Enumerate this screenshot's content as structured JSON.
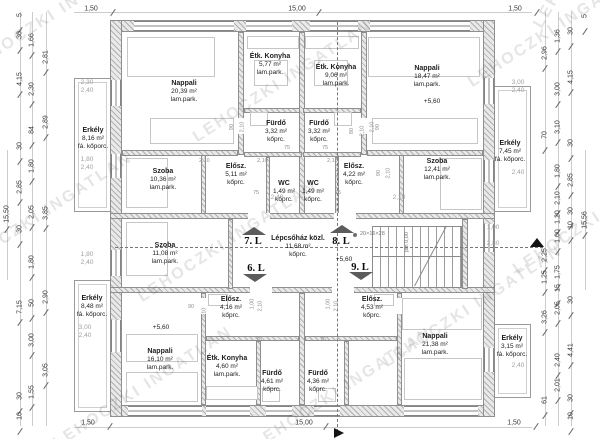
{
  "drawing": {
    "watermark_text": "LEHOCZKI INGATLAN",
    "rooms": [
      {
        "n": "Nappali",
        "a": "20,39 m²",
        "f": "lam.park.",
        "x": 184,
        "y": 80
      },
      {
        "n": "Étk. Konyha",
        "a": "5,77 m²",
        "f": "lam.park.",
        "x": 270,
        "y": 53
      },
      {
        "n": "Fürdő",
        "a": "3,32 m²",
        "f": "kőprc.",
        "x": 276,
        "y": 120
      },
      {
        "n": "Szoba",
        "a": "10,36 m²",
        "f": "lam.park.",
        "x": 163,
        "y": 168
      },
      {
        "n": "Elősz.",
        "a": "5,11 m²",
        "f": "kőprc.",
        "x": 236,
        "y": 163
      },
      {
        "n": "WC",
        "a": "1,49 m²",
        "f": "kőprc.",
        "x": 284,
        "y": 180
      },
      {
        "n": "WC",
        "a": "1,49 m²",
        "f": "kőprc.",
        "x": 313,
        "y": 180
      },
      {
        "n": "Étk. Konyha",
        "a": "9,06 m²",
        "f": "lam.park.",
        "x": 336,
        "y": 64
      },
      {
        "n": "Nappali",
        "a": "18,47 m²",
        "f": "lam.park.",
        "x": 427,
        "y": 65
      },
      {
        "n": "Fürdő",
        "a": "3,32 m²",
        "f": "kőprc.",
        "x": 319,
        "y": 120
      },
      {
        "n": "Elősz.",
        "a": "4,22 m²",
        "f": "kőprc.",
        "x": 354,
        "y": 163
      },
      {
        "n": "Szoba",
        "a": "12,41 m²",
        "f": "lam.park.",
        "x": 437,
        "y": 158
      },
      {
        "n": "Erkély",
        "a": "8,16 m²",
        "f": "fá. kőporc.",
        "x": 93,
        "y": 127
      },
      {
        "n": "Erkély",
        "a": "7,45 m²",
        "f": "fá. kőporc.",
        "x": 510,
        "y": 140
      },
      {
        "n": "Szoba",
        "a": "11,08 m²",
        "f": "lam.park.",
        "x": 165,
        "y": 242
      },
      {
        "n": "Lépcsőház közl.",
        "a": "11,68 m²",
        "f": "kőprc.",
        "x": 298,
        "y": 235
      },
      {
        "n": "Erkély",
        "a": "8,48 m²",
        "f": "fá. kőporc.",
        "x": 92,
        "y": 295
      },
      {
        "n": "Elősz.",
        "a": "4,16 m²",
        "f": "kőprc.",
        "x": 231,
        "y": 296
      },
      {
        "n": "Elősz.",
        "a": "4,53 m²",
        "f": "kőprc.",
        "x": 372,
        "y": 296
      },
      {
        "n": "Étk. Konyha",
        "a": "4,60 m²",
        "f": "lam.park.",
        "x": 227,
        "y": 355
      },
      {
        "n": "Fürdő",
        "a": "4,61 m²",
        "f": "kőprc.",
        "x": 272,
        "y": 370
      },
      {
        "n": "Fürdő",
        "a": "4,36 m²",
        "f": "kőprc.",
        "x": 318,
        "y": 370
      },
      {
        "n": "Nappali",
        "a": "16,10 m²",
        "f": "lam.park.",
        "x": 160,
        "y": 348
      },
      {
        "n": "Nappali",
        "a": "21,38 m²",
        "f": "lam.park.",
        "x": 435,
        "y": 333
      },
      {
        "n": "Erkély",
        "a": "3,15 m²",
        "f": "fá. kőporc.",
        "x": 512,
        "y": 335
      }
    ],
    "units": [
      {
        "t": "7. L",
        "x": 253,
        "y": 236,
        "d": "up",
        "ax": 254,
        "ay": 227
      },
      {
        "t": "8. L",
        "x": 341,
        "y": 236,
        "d": "up",
        "ax": 342,
        "ay": 225
      },
      {
        "t": "6. L",
        "x": 256,
        "y": 263,
        "d": "down",
        "ax": 255,
        "ay": 274
      },
      {
        "t": "9. L",
        "x": 360,
        "y": 262,
        "d": "down",
        "ax": 361,
        "ay": 272
      }
    ],
    "levels": [
      {
        "t": "+5,60",
        "x": 432,
        "y": 98
      },
      {
        "t": "+5,60",
        "x": 344,
        "y": 256
      },
      {
        "t": "+5,60",
        "x": 161,
        "y": 324
      }
    ],
    "dims_h": [
      {
        "t": "1,50",
        "x": 91,
        "y": 5
      },
      {
        "t": "15,00",
        "x": 297,
        "y": 5
      },
      {
        "t": "1,50",
        "x": 515,
        "y": 5
      },
      {
        "t": "1,50",
        "x": 88,
        "y": 419
      },
      {
        "t": "15,00",
        "x": 304,
        "y": 419
      },
      {
        "t": "1,50",
        "x": 514,
        "y": 419
      }
    ],
    "dims_v": [
      {
        "t": "5",
        "x": 20,
        "y": 15
      },
      {
        "t": "30",
        "x": 20,
        "y": 35
      },
      {
        "t": "4,15",
        "x": 20,
        "y": 79
      },
      {
        "t": "30",
        "x": 20,
        "y": 146
      },
      {
        "t": "2,85",
        "x": 20,
        "y": 187
      },
      {
        "t": "30",
        "x": 20,
        "y": 229
      },
      {
        "t": "7,15",
        "x": 20,
        "y": 307
      },
      {
        "t": "30",
        "x": 20,
        "y": 396
      },
      {
        "t": "10",
        "x": 20,
        "y": 416
      },
      {
        "t": "1,66",
        "x": 32,
        "y": 40
      },
      {
        "t": "2,30",
        "x": 32,
        "y": 89
      },
      {
        "t": "84",
        "x": 32,
        "y": 130
      },
      {
        "t": "1,80",
        "x": 32,
        "y": 166
      },
      {
        "t": "2,05",
        "x": 32,
        "y": 212
      },
      {
        "t": "1,80",
        "x": 32,
        "y": 262
      },
      {
        "t": "50",
        "x": 32,
        "y": 303
      },
      {
        "t": "3,00",
        "x": 32,
        "y": 340
      },
      {
        "t": "1,55",
        "x": 32,
        "y": 392
      },
      {
        "t": "2,81",
        "x": 46,
        "y": 57
      },
      {
        "t": "2,89",
        "x": 46,
        "y": 122
      },
      {
        "t": "3,85",
        "x": 46,
        "y": 213
      },
      {
        "t": "2,90",
        "x": 46,
        "y": 297
      },
      {
        "t": "3,05",
        "x": 46,
        "y": 370
      },
      {
        "t": "15,50",
        "x": 7,
        "y": 214
      },
      {
        "t": "2,96",
        "x": 545,
        "y": 53
      },
      {
        "t": "70",
        "x": 545,
        "y": 135
      },
      {
        "t": "2,25",
        "x": 545,
        "y": 255
      },
      {
        "t": "1,25",
        "x": 545,
        "y": 277
      },
      {
        "t": "3,26",
        "x": 545,
        "y": 317
      },
      {
        "t": "61",
        "x": 545,
        "y": 400
      },
      {
        "t": "1,36",
        "x": 558,
        "y": 36
      },
      {
        "t": "3,00",
        "x": 558,
        "y": 89
      },
      {
        "t": "3,10",
        "x": 558,
        "y": 127
      },
      {
        "t": "1,80",
        "x": 558,
        "y": 171
      },
      {
        "t": "2,10",
        "x": 558,
        "y": 198
      },
      {
        "t": "1,20",
        "x": 558,
        "y": 217
      },
      {
        "t": "1,00",
        "x": 558,
        "y": 236
      },
      {
        "t": "1,75",
        "x": 558,
        "y": 272
      },
      {
        "t": "15",
        "x": 558,
        "y": 288
      },
      {
        "t": "2,05",
        "x": 558,
        "y": 308
      },
      {
        "t": "2,40",
        "x": 558,
        "y": 360
      },
      {
        "t": "2,01",
        "x": 558,
        "y": 385
      },
      {
        "t": "30",
        "x": 571,
        "y": 31
      },
      {
        "t": "4,15",
        "x": 571,
        "y": 77
      },
      {
        "t": "30",
        "x": 571,
        "y": 143
      },
      {
        "t": "2,85",
        "x": 571,
        "y": 180
      },
      {
        "t": "30",
        "x": 571,
        "y": 211
      },
      {
        "t": "10",
        "x": 571,
        "y": 225
      },
      {
        "t": "30",
        "x": 571,
        "y": 300
      },
      {
        "t": "4,41",
        "x": 571,
        "y": 350
      },
      {
        "t": "30",
        "x": 571,
        "y": 398
      },
      {
        "t": "10",
        "x": 571,
        "y": 416
      },
      {
        "t": "5",
        "x": 585,
        "y": 16
      },
      {
        "t": "15,56",
        "x": 585,
        "y": 220
      }
    ],
    "specs": [
      {
        "x": 87,
        "y": 79,
        "l": [
          "2,30",
          "2,40"
        ]
      },
      {
        "x": 87,
        "y": 156,
        "l": [
          "1,80",
          "2,40"
        ]
      },
      {
        "x": 87,
        "y": 251,
        "l": [
          "1,80",
          "2,40"
        ]
      },
      {
        "x": 85,
        "y": 324,
        "l": [
          "3,00",
          "2,40"
        ]
      },
      {
        "x": 518,
        "y": 79,
        "l": [
          "3,00",
          "2,40"
        ]
      },
      {
        "x": 518,
        "y": 169,
        "l": [
          "2,40"
        ]
      },
      {
        "x": 493,
        "y": 224,
        "l": [
          "1,00"
        ]
      },
      {
        "x": 493,
        "y": 240,
        "l": [
          "2,80"
        ]
      },
      {
        "x": 518,
        "y": 362,
        "l": [
          "2,40"
        ]
      },
      {
        "x": 277,
        "y": 194,
        "l": [
          "2,40"
        ]
      },
      {
        "x": 399,
        "y": 194,
        "l": [
          "2,10"
        ]
      }
    ],
    "small": [
      {
        "t": "90",
        "x": 229,
        "y": 124,
        "r": -90
      },
      {
        "t": "2,10",
        "x": 237,
        "y": 124,
        "r": -90
      },
      {
        "t": "90",
        "x": 375,
        "y": 124,
        "r": -90
      },
      {
        "t": "2,10",
        "x": 367,
        "y": 124,
        "r": -90
      },
      {
        "t": "80",
        "x": 349,
        "y": 128,
        "r": -90
      },
      {
        "t": "2,10",
        "x": 357,
        "y": 128,
        "r": -90
      },
      {
        "t": "90",
        "x": 376,
        "y": 170,
        "r": -90
      },
      {
        "t": "2,10",
        "x": 383,
        "y": 170,
        "r": -90
      },
      {
        "t": "2,10",
        "x": 199,
        "y": 158,
        "r": 0
      },
      {
        "t": "2,10",
        "x": 257,
        "y": 158,
        "r": 0
      },
      {
        "t": "2,10",
        "x": 327,
        "y": 158,
        "r": 0
      },
      {
        "t": "75",
        "x": 284,
        "y": 145,
        "r": 0
      },
      {
        "t": "75",
        "x": 322,
        "y": 145,
        "r": 0
      },
      {
        "t": "75",
        "x": 253,
        "y": 190,
        "r": 0
      },
      {
        "t": "75",
        "x": 335,
        "y": 190,
        "r": 0
      },
      {
        "t": "75",
        "x": 256,
        "y": 337,
        "r": 0
      },
      {
        "t": "75",
        "x": 320,
        "y": 337,
        "r": 0
      },
      {
        "t": "90",
        "x": 188,
        "y": 304,
        "r": 0
      },
      {
        "t": "2,10",
        "x": 199,
        "y": 310,
        "r": -90
      },
      {
        "t": "1,00",
        "x": 247,
        "y": 301,
        "r": -90
      },
      {
        "t": "2,10",
        "x": 255,
        "y": 303,
        "r": -90
      },
      {
        "t": "1,00",
        "x": 323,
        "y": 301,
        "r": -90
      },
      {
        "t": "2,10",
        "x": 331,
        "y": 303,
        "r": -90
      }
    ],
    "watermarks": [
      {
        "t": "LEHOCZKI INGATLAN",
        "x": -30,
        "y": 60,
        "r": -33
      },
      {
        "t": "LEHOCZKI INGATLAN",
        "x": -45,
        "y": 262,
        "r": -33
      },
      {
        "t": "LEHOCZKI INGATLAN",
        "x": 140,
        "y": 290,
        "r": -33
      },
      {
        "t": "LEHOCZKI INGATLAN",
        "x": 195,
        "y": 130,
        "r": -33
      },
      {
        "t": "LEHOCZKI INGATLAN",
        "x": 385,
        "y": 355,
        "r": -33
      },
      {
        "t": "LEHOCZKI INGATLAN",
        "x": 55,
        "y": 436,
        "r": -33
      },
      {
        "t": "LEHOCZKI INGATLAN",
        "x": 255,
        "y": 437,
        "r": -33
      },
      {
        "t": "LEHOCZKI INGATLAN",
        "x": 470,
        "y": 75,
        "r": -33
      },
      {
        "t": "LEHOCZKI INGATLAN",
        "x": 515,
        "y": 262,
        "r": -33
      },
      {
        "t": "LEHOCZKI",
        "x": 538,
        "y": 18,
        "r": -60
      }
    ],
    "notes": {
      "stair_steps": "20×16×28",
      "stair_steps_x": 360,
      "stair_steps_y": 231,
      "landing_level": "pm 0,00",
      "landing_level_x": 404,
      "landing_level_y": 252
    }
  }
}
